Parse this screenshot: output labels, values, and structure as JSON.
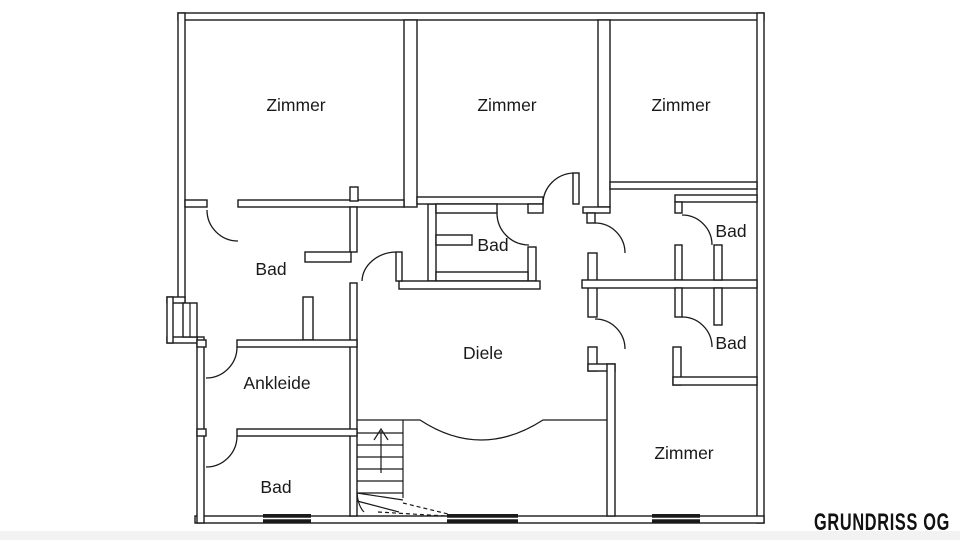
{
  "plan": {
    "title": "GRUNDRISS OG",
    "rooms": [
      {
        "id": "zimmer-top-left",
        "label": "Zimmer"
      },
      {
        "id": "zimmer-top-middle",
        "label": "Zimmer"
      },
      {
        "id": "zimmer-top-right",
        "label": "Zimmer"
      },
      {
        "id": "bad-left",
        "label": "Bad"
      },
      {
        "id": "bad-middle",
        "label": "Bad"
      },
      {
        "id": "bad-right-upper",
        "label": "Bad"
      },
      {
        "id": "diele",
        "label": "Diele"
      },
      {
        "id": "bad-right-lower",
        "label": "Bad"
      },
      {
        "id": "ankleide",
        "label": "Ankleide"
      },
      {
        "id": "bad-bottom-left",
        "label": "Bad"
      },
      {
        "id": "zimmer-bottom-right",
        "label": "Zimmer"
      }
    ],
    "colors": {
      "line": "#1a1a1a",
      "background": "#ffffff"
    },
    "stairs": {
      "direction": "up"
    }
  }
}
